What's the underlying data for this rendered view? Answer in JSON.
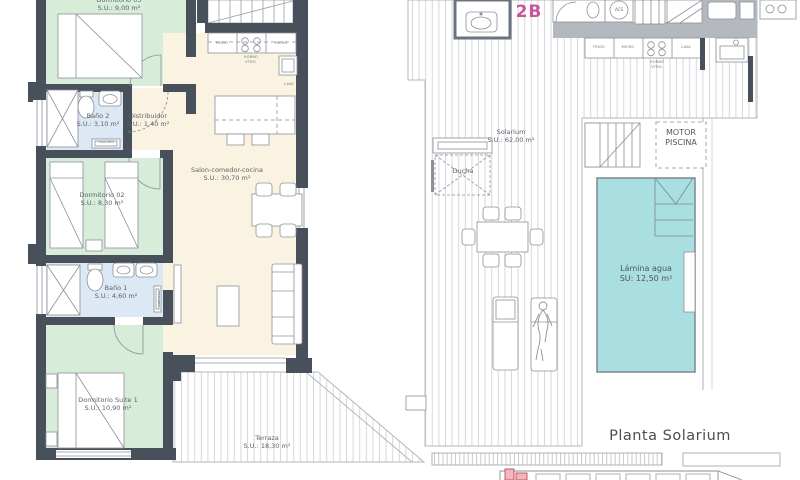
{
  "title_labels": {
    "unit": "2B",
    "plan": "Planta Solarium"
  },
  "colors": {
    "wall": "#47505b",
    "bedroom_fill": "#d8ecda",
    "bathroom_fill": "#dce8f4",
    "living_fill": "#faf3e2",
    "pool_fill": "#a9dfe1",
    "accent_magenta": "#c8549e",
    "keyplan_highlight": "#f3b6bf",
    "line_gray": "#8b9097"
  },
  "apartment": {
    "rooms": [
      {
        "name": "Dormitorio 03",
        "area": "S.U.: 9,00 m²"
      },
      {
        "name": "Baño 2",
        "area": "S.U.: 3,10 m²"
      },
      {
        "name": "Distribuidor",
        "area": "S.U.: 1,40 m²"
      },
      {
        "name": "Salon-comedor-cocina",
        "area": "S.U.: 30,70 m²"
      },
      {
        "name": "Dormitorio 02",
        "area": "S.U.: 8,30 m²"
      },
      {
        "name": "Baño 1",
        "area": "S.U.: 4,60 m²"
      },
      {
        "name": "Dormitorio Suite 1",
        "area": "S.U.: 10,90 m²"
      },
      {
        "name": "Terraza",
        "area": "S.U.: 18,30 m²"
      }
    ],
    "kitchen": {
      "frigo": "FRIGO",
      "micro": "MICRO",
      "horno": "HORNO",
      "vtro": "VTRO.",
      "lava": "LAVA"
    },
    "fixtures": {
      "toallero": "TOALLERO"
    }
  },
  "solarium": {
    "rooms": [
      {
        "name": "Solarium",
        "area": "S.U.: 62,00 m²"
      },
      {
        "name": "Lámina agua",
        "area": "SU:  12,50 m²"
      }
    ],
    "labels": {
      "ducha": "Ducha",
      "motor1": "MOTOR",
      "motor2": "PISCINA",
      "acs": "ACS"
    },
    "kitchen": {
      "frigo": "FRIGO",
      "micro": "MICRO",
      "horno": "HORNO",
      "vtro": "VTRO.",
      "lava": "LAVA"
    }
  }
}
